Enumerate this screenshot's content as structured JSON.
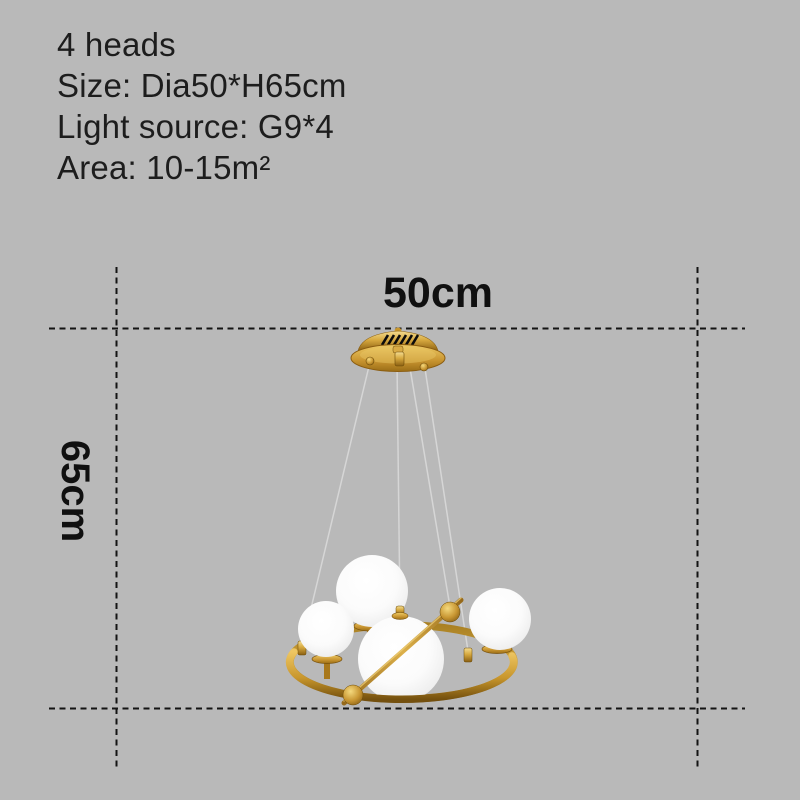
{
  "product_specs": {
    "lines": [
      "4 heads",
      "Size: Dia50*H65cm",
      "Light source: G9*4",
      "Area: 10-15m²"
    ]
  },
  "dimensions": {
    "diameter_label": "50cm",
    "height_label": "65cm"
  },
  "colors": {
    "background": "#b9b9b9",
    "spec_text": "#1d1d1d",
    "dimension_text": "#101010",
    "dimension_line": "#141414",
    "gold_light": "#f2d98e",
    "gold_mid": "#d0a13a",
    "gold_dark": "#7c5510",
    "glass_white": "#fdfdfd",
    "wire_gray": "#d6d6d6"
  }
}
